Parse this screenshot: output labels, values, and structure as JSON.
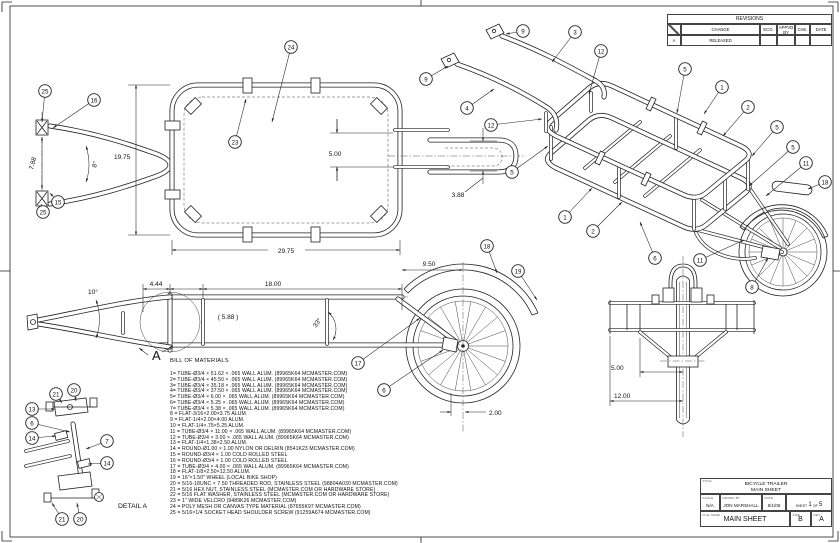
{
  "revisions": {
    "title": "REVISIONS",
    "col_change": "CHANGE",
    "col_eco": "ECO.",
    "col_appvd": "APPVD BY",
    "col_chk": "CHK.",
    "col_date": "DATE",
    "row_rev": "A",
    "row_change": "RELEASED"
  },
  "title_block": {
    "title_label": "TITLE",
    "title_line1": "BICYCLE TRAILER",
    "title_line2": "MAIN SHEET",
    "scale_label": "SCALE",
    "scale_value": "N/A",
    "drawn_label": "DRAWN BY",
    "drawn_value": "JON MARSHALL",
    "date_label": "DATE",
    "date_value": "8/1/05",
    "sheet_label": "SHEET",
    "sheet_num": "1",
    "of_label": "OF",
    "sheet_total": "5",
    "file_label": "FILE NAME",
    "file_value": "MAIN SHEET",
    "size_label": "SIZE",
    "size_value": "B",
    "rev_label": "REV",
    "rev_value": "A"
  },
  "bom": {
    "title": "BILL OF MATERIALS",
    "items": [
      "1= TUBE-Ø3/4 × 51.62 × .065 WALL ALUM.  (89965K64 MCMASTER.COM)",
      "2= TUBE-Ø3/4 × 45.50 × .065 WALL ALUM.  (89965K64 MCMASTER.COM)",
      "3= TUBE-Ø3/4 × 35.18 × .065 WALL ALUM.  (89965K64 MCMASTER.COM)",
      "4= TUBE-Ø3/4 × 37.50 × .065 WALL ALUM.  (89965K64 MCMASTER.COM)",
      "5= TUBE-Ø3/4 × 6.00 × .065 WALL ALUM.  (89965K64 MCMASTER.COM)",
      "6= TUBE-Ø3/4 × 5.25 × .065 WALL ALUM.  (89965K64 MCMASTER.COM)",
      "7= TUBE-Ø3/4 × 5.38 × .065 WALL ALUM.  (89965K64 MCMASTER.COM)",
      "8 = FLAT-3/16×2.00×3.75 ALUM.",
      "9 = FLAT-1/4×2.00×4.00 ALUM.",
      "10 = FLAT-1/4×.75×5.25 ALUM.",
      "11 = TUBE-Ø3/4 × 11.00 × .065 WALL ALUM.  (89965K64 MCMASTER.COM)",
      "12 = TUBE-Ø3/4 × 3.00 × .065 WALL ALUM.  (89965K64 MCMASTER.COM)",
      "13 = FLAT-1/4×1.38×2.50 ALUM.",
      "14 = ROUND-Ø1.00 × 1.00 NYLON OR DELRIN  (8541K23 MCMASTER.COM)",
      "15 = ROUND-Ø3/4 × 1.00 COLD ROLLED STEEL",
      "16 = ROUND-Ø3/4 × 1.00 COLD ROLLED STEEL",
      "17 = TUBE-Ø3/4 × 4.00 × .065 WALL ALUM.  (89965K64 MCMASTER.COM)",
      "18 = FLAT-1/8×2.50×12.50 ALUM.",
      "19 = 16\"×1.50\" WHEEL (LOCAL BIKE SHOP)",
      "20 = 5/16-18UNC × 7.50 THREADED ROD, STAINLESS STEEL (98804A030 MCMASTER.COM)",
      "21 = 5/16 HEX NUT, STAINLESS STEEL (MCMASTER.COM OR HARDWARE STORE)",
      "22 = 5/16 FLAT WASHER, STAINLESS STEEL (MCMASTER.COM OR HARDWARE STORE)",
      "23 = 1\" WIDE VELCRO (9489K26 MCMASTER.COM)",
      "24 = POLY MESH OR CANVAS TYPE MATERIAL (87655K97 MCMASTER.COM)",
      "25 = 5/16×1/4 SOCKET HEAD SHOULDER SCREW (91259A674 MCMASTER.COM)"
    ]
  },
  "front_view": {
    "dim_width": "7.88",
    "dim_angle": "8°",
    "dim_height": "19.75",
    "balloons": [
      "25",
      "16",
      "15",
      "25"
    ]
  },
  "top_view": {
    "dim_width": "29.75",
    "dim_gap": "5.00",
    "dim_slot": "3.88",
    "balloons": [
      "24",
      "23"
    ]
  },
  "iso_view": {
    "balloons": [
      "9",
      "3",
      "12",
      "9",
      "4",
      "12",
      "5",
      "5",
      "1",
      "2",
      "5",
      "5",
      "11",
      "18",
      "1",
      "2",
      "6",
      "11",
      "8"
    ]
  },
  "side_view": {
    "dim_angle_tongue": "10°",
    "dim_a": "4.44",
    "dim_b": "18.00",
    "dim_ref": "( 5.88 )",
    "dim_strut_angle": "33°",
    "dim_c": "9.50",
    "dim_d": "2.00",
    "section_letter": "A",
    "balloons": [
      "18",
      "19",
      "17",
      "6"
    ]
  },
  "rear_view": {
    "dim_a": "5.00",
    "dim_b": "12.00"
  },
  "detail_view": {
    "label": "DETAIL A",
    "balloons": [
      "21",
      "20",
      "13",
      "6",
      "14",
      "7",
      "14",
      "21",
      "20"
    ]
  }
}
